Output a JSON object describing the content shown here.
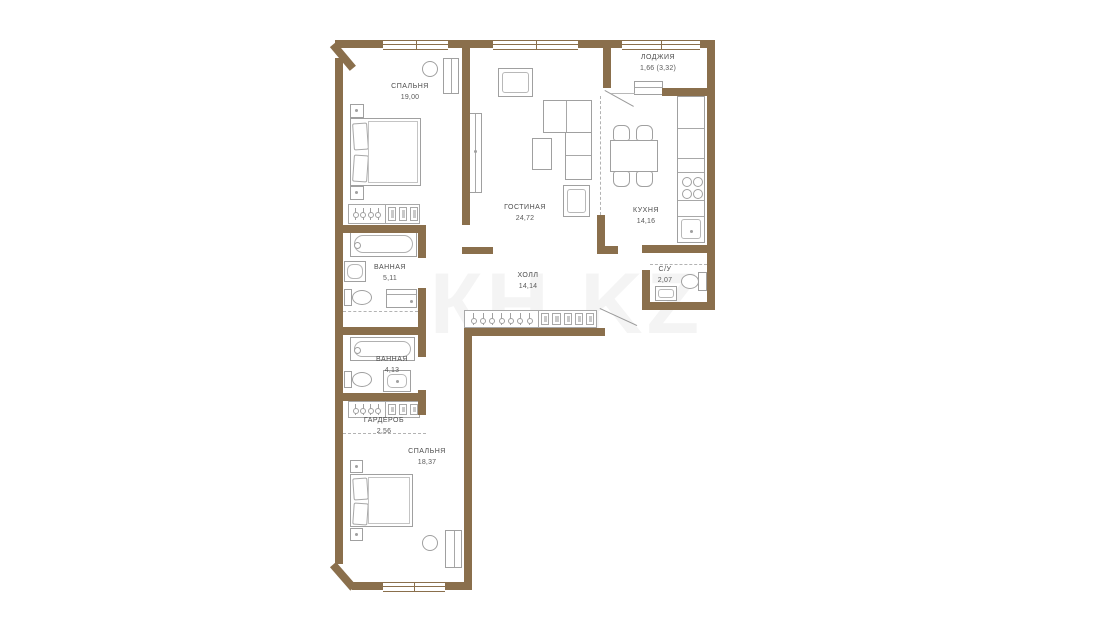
{
  "watermark": "КН.KZ",
  "rooms": [
    {
      "name": "СПАЛЬНЯ",
      "area": "19,00"
    },
    {
      "name": "ГОСТИНАЯ",
      "area": "24,72"
    },
    {
      "name": "ЛОДЖИЯ",
      "area": "1,66 (3,32)"
    },
    {
      "name": "КУХНЯ",
      "area": "14,16"
    },
    {
      "name": "ВАННАЯ",
      "area": "5,11"
    },
    {
      "name": "ХОЛЛ",
      "area": "14,14"
    },
    {
      "name": "С/У",
      "area": "2,07"
    },
    {
      "name": "ВАННАЯ",
      "area": "4,13"
    },
    {
      "name": "ГАРДЕРОБ",
      "area": "2,56"
    },
    {
      "name": "СПАЛЬНЯ",
      "area": "18,37"
    }
  ]
}
